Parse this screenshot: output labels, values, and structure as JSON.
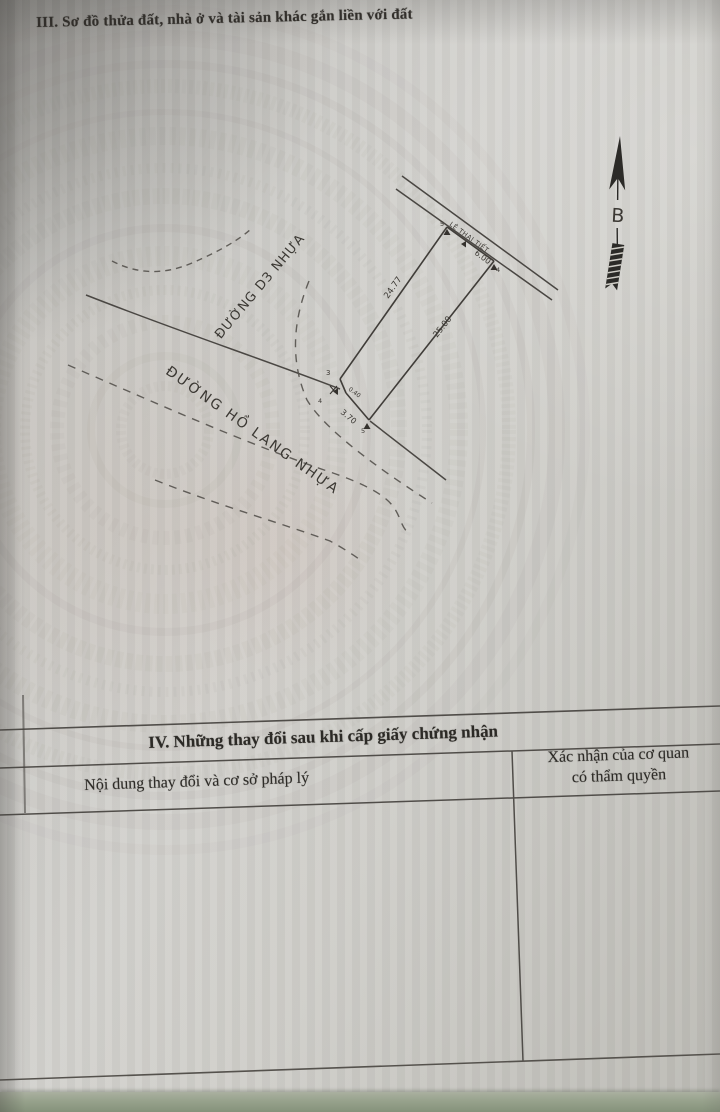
{
  "document": {
    "section3_title": "III. Sơ đồ thửa đất, nhà ở và tài sản khác gắn liền với đất",
    "section4": {
      "title": "IV. Những thay đổi sau khi cấp giấy chứng nhận",
      "col1_header": "Nội dung thay đổi và cơ sở pháp lý",
      "col2_header_line1": "Xác nhận của cơ quan",
      "col2_header_line2": "có thẩm quyền"
    }
  },
  "diagram": {
    "north_label": "B",
    "road_labels": {
      "d3": "ĐƯỜNG D3 NHỰA",
      "ho_lang": "ĐƯỜNG HỒ LANG  NHỰA",
      "frontage_street": "LÊ THAI TIẾT"
    },
    "dimensions": {
      "left_edge": "24.77",
      "right_edge": "25.00",
      "top_frontage": "6.00",
      "bottom_frontage": "3.70",
      "corner_chamfer": "0.40"
    },
    "vertex_labels": {
      "v3": "3",
      "v4a": "4",
      "v4b": "4",
      "v5a": "5",
      "v5b": "5"
    }
  },
  "colors": {
    "paper": "#cfcec9",
    "ink": "#37342f",
    "line": "#4a4845",
    "bottom_band_green": "#87927b"
  }
}
